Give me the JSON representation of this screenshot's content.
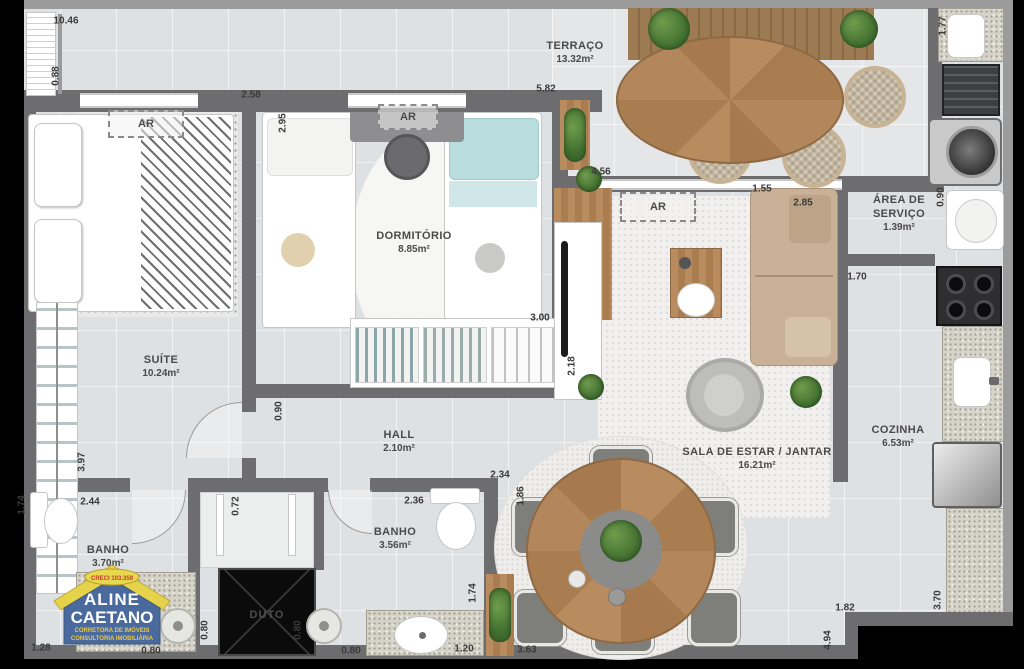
{
  "palette": {
    "wall": "#6d6d6f",
    "floor": "#dee1e4",
    "terrace_floor": "#e4e6e7",
    "wood": "#b2855a",
    "granite": "#d6d3c9",
    "logo_blue": "#4a6a9e",
    "logo_yellow": "#e5d44b",
    "logo_red": "#c03a2e"
  },
  "rooms": [
    {
      "id": "terraco",
      "name": "TERRAÇO",
      "area": "13.32m²",
      "cx": 575,
      "cy": 53
    },
    {
      "id": "dormitorio",
      "name": "DORMITÓRIO",
      "area": "8.85m²",
      "cx": 414,
      "cy": 243
    },
    {
      "id": "suite",
      "name": "SUÍTE",
      "area": "10.24m²",
      "cx": 161,
      "cy": 367
    },
    {
      "id": "hall",
      "name": "HALL",
      "area": "2.10m²",
      "cx": 399,
      "cy": 442
    },
    {
      "id": "sala-estar-jantar",
      "name": "SALA DE ESTAR / JANTAR",
      "area": "16.21m²",
      "cx": 757,
      "cy": 459
    },
    {
      "id": "area-servico",
      "name": "ÁREA DE\nSERVIÇO",
      "area": "1.39m²",
      "cx": 899,
      "cy": 214
    },
    {
      "id": "cozinha",
      "name": "COZINHA",
      "area": "6.53m²",
      "cx": 898,
      "cy": 437
    },
    {
      "id": "banho-suite",
      "name": "BANHO",
      "area": "3.70m²",
      "cx": 108,
      "cy": 557
    },
    {
      "id": "banho-social",
      "name": "BANHO",
      "area": "3.56m²",
      "cx": 395,
      "cy": 539
    },
    {
      "id": "duto",
      "name": "DUTO",
      "area": "",
      "cx": 267,
      "cy": 616,
      "variant": "duto"
    }
  ],
  "dimensions": [
    {
      "value": "10.46",
      "cx": 66,
      "cy": 21,
      "v": false
    },
    {
      "value": "0.88",
      "cx": 56,
      "cy": 76,
      "v": true
    },
    {
      "value": "2.58",
      "cx": 251,
      "cy": 95,
      "v": false
    },
    {
      "value": "2.95",
      "cx": 283,
      "cy": 123,
      "v": true
    },
    {
      "value": "5.82",
      "cx": 546,
      "cy": 89,
      "v": false
    },
    {
      "value": "4.56",
      "cx": 601,
      "cy": 172,
      "v": false
    },
    {
      "value": "1.77",
      "cx": 943,
      "cy": 26,
      "v": true
    },
    {
      "value": "1.55",
      "cx": 762,
      "cy": 189,
      "v": false
    },
    {
      "value": "2.85",
      "cx": 803,
      "cy": 203,
      "v": false
    },
    {
      "value": "0.90",
      "cx": 941,
      "cy": 197,
      "v": true
    },
    {
      "value": "1.70",
      "cx": 857,
      "cy": 277,
      "v": false
    },
    {
      "value": "3.00",
      "cx": 540,
      "cy": 318,
      "v": false
    },
    {
      "value": "2.18",
      "cx": 572,
      "cy": 366,
      "v": true
    },
    {
      "value": "0.90",
      "cx": 279,
      "cy": 411,
      "v": true
    },
    {
      "value": "3.97",
      "cx": 82,
      "cy": 462,
      "v": true
    },
    {
      "value": "2.44",
      "cx": 90,
      "cy": 502,
      "v": false
    },
    {
      "value": "1.74",
      "cx": 22,
      "cy": 505,
      "v": true
    },
    {
      "value": "2.34",
      "cx": 500,
      "cy": 475,
      "v": false
    },
    {
      "value": "2.36",
      "cx": 414,
      "cy": 501,
      "v": false
    },
    {
      "value": "1.86",
      "cx": 521,
      "cy": 496,
      "v": true
    },
    {
      "value": "0.72",
      "cx": 236,
      "cy": 506,
      "v": true
    },
    {
      "value": "1.28",
      "cx": 41,
      "cy": 648,
      "v": false
    },
    {
      "value": "0.80",
      "cx": 151,
      "cy": 651,
      "v": false
    },
    {
      "value": "0.80",
      "cx": 205,
      "cy": 630,
      "v": true
    },
    {
      "value": "0.80",
      "cx": 298,
      "cy": 630,
      "v": true
    },
    {
      "value": "0.80",
      "cx": 351,
      "cy": 651,
      "v": false
    },
    {
      "value": "1.20",
      "cx": 464,
      "cy": 649,
      "v": false
    },
    {
      "value": "1.74",
      "cx": 473,
      "cy": 593,
      "v": true
    },
    {
      "value": "3.63",
      "cx": 527,
      "cy": 650,
      "v": false
    },
    {
      "value": "1.82",
      "cx": 845,
      "cy": 608,
      "v": false
    },
    {
      "value": "3.70",
      "cx": 938,
      "cy": 600,
      "v": true
    },
    {
      "value": "4.94",
      "cx": 828,
      "cy": 640,
      "v": true
    }
  ],
  "ar_boxes": [
    {
      "label": "AR",
      "x": 108,
      "y": 110,
      "w": 72,
      "h": 24
    },
    {
      "label": "AR",
      "x": 378,
      "y": 104,
      "w": 56,
      "h": 22
    },
    {
      "label": "AR",
      "x": 620,
      "y": 192,
      "w": 72,
      "h": 26
    }
  ],
  "logo": {
    "ribbon": "CRECI 103.359",
    "name1": "ALINE",
    "name2": "CAETANO",
    "sub1": "CORRETORA DE IMÓVEIS",
    "sub2": "CONSULTORIA IMOBILIÁRIA"
  }
}
